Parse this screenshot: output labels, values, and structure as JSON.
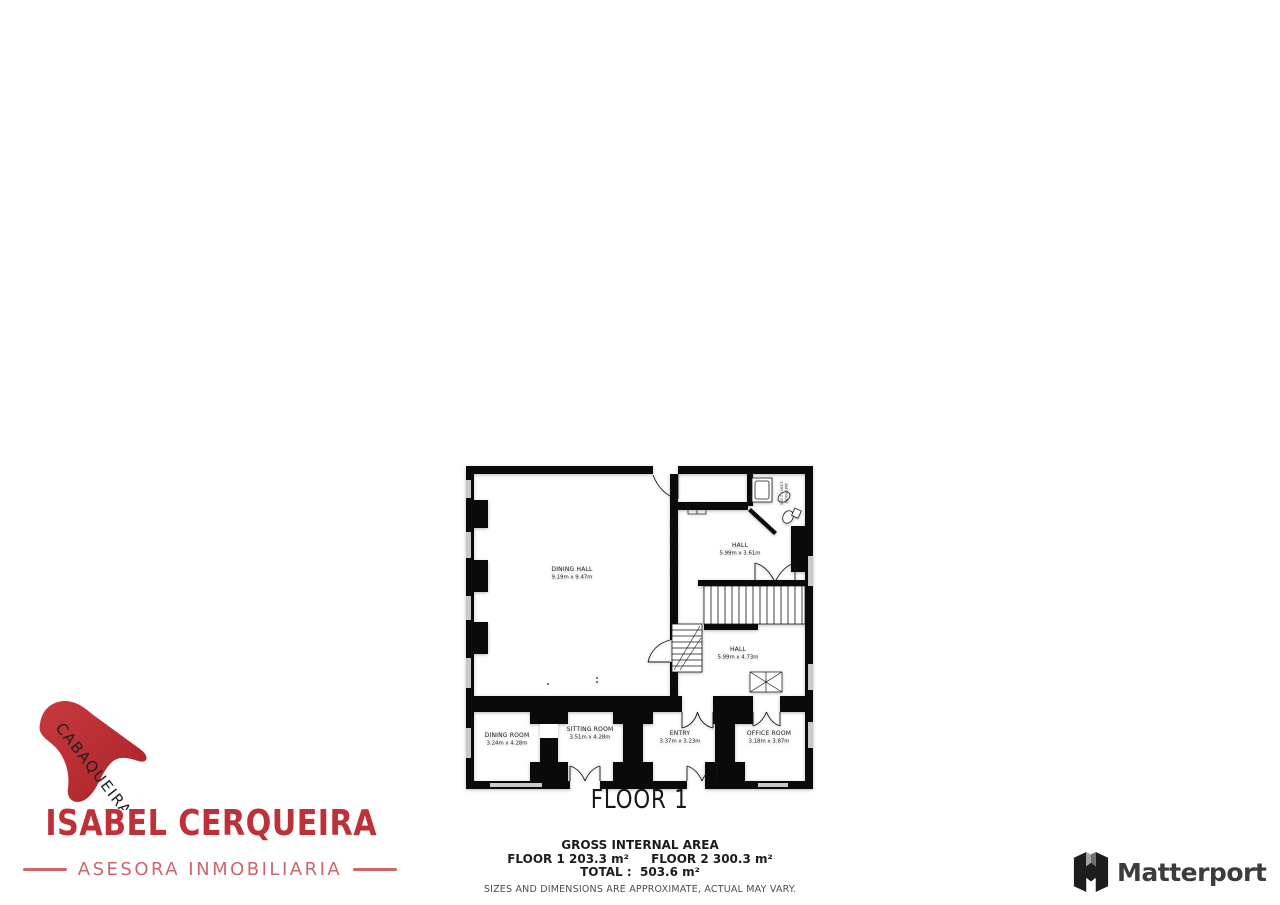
{
  "floor_plan": {
    "floor_label": "FLOOR 1",
    "rooms": {
      "dining_hall": {
        "name": "DINING HALL",
        "dims": "9.19m x 9.47m"
      },
      "hall_upper": {
        "name": "HALL",
        "dims": "5.99m x 3.61m"
      },
      "hall_lower": {
        "name": "HALL",
        "dims": "5.99m x 4.73m"
      },
      "dining_room": {
        "name": "DINING ROOM",
        "dims": "3.24m x 4.28m"
      },
      "sitting_room": {
        "name": "SITTING ROOM",
        "dims": "3.51m x 4.28m"
      },
      "entry": {
        "name": "ENTRY",
        "dims": "3.37m x 3.23m"
      },
      "office_room": {
        "name": "OFFICE ROOM",
        "dims": "3.18m x 3.87m"
      },
      "bathroom": {
        "name": "BATHROOM",
        "dims": "1.95m x 2.20m"
      }
    }
  },
  "footer": {
    "gross_title": "GROSS INTERNAL AREA",
    "floor1_area": "FLOOR 1 203.3 m²",
    "floor2_area": "FLOOR 2 300.3 m²",
    "total_area": "TOTAL :  503.6 m²",
    "disclaimer": "SIZES AND DIMENSIONS ARE APPROXIMATE, ACTUAL MAY VARY."
  },
  "agency_logo": {
    "roof_text": "CABAQUEIRA",
    "name": "ISABEL CERQUEIRA",
    "tagline": "ASESORA INMOBILIARIA",
    "colors": {
      "primary_red": "#bf3138",
      "light_red": "#cf646b",
      "roof_red": "#b5282e"
    }
  },
  "matterport_logo": {
    "label": "Matterport",
    "text_color": "#3c3c3c"
  }
}
